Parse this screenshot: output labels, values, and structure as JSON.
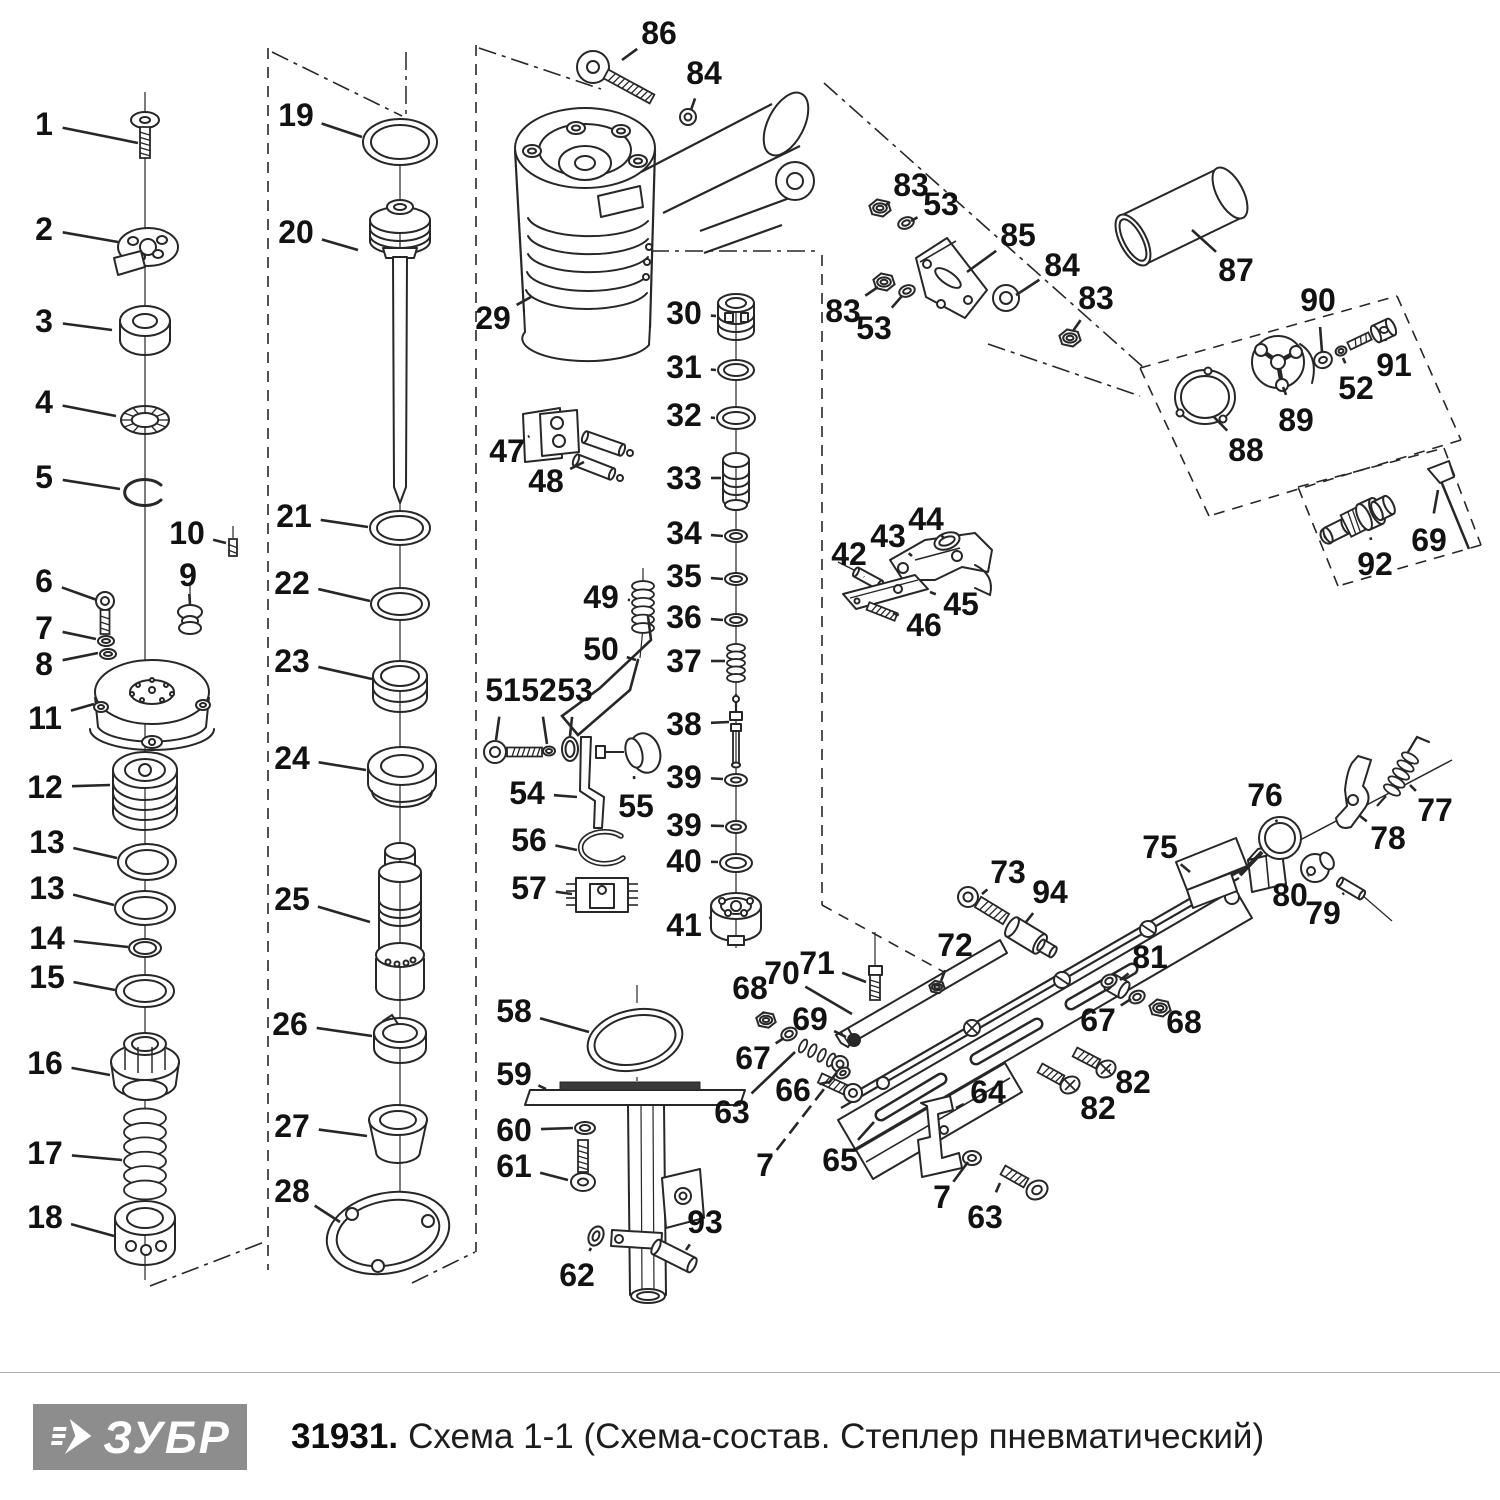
{
  "meta": {
    "brand": "ЗУБР",
    "product_code": "31931.",
    "title": "Схема 1-1 (Схема-состав. Степлер пневматический)"
  },
  "colors": {
    "ink": "#272727",
    "label": "#121212",
    "logo_bg": "#8d8d8d",
    "logo_fg": "#ffffff",
    "rule": "#ababab",
    "paper": "#ffffff"
  },
  "diagram": {
    "description": "exploded-parts-diagram-pneumatic-stapler",
    "labels": [
      {
        "n": "1",
        "x": 44,
        "y": 124,
        "ex": 138,
        "ey": 143
      },
      {
        "n": "2",
        "x": 44,
        "y": 229,
        "ex": 118,
        "ey": 242
      },
      {
        "n": "3",
        "x": 44,
        "y": 321,
        "ex": 112,
        "ey": 330
      },
      {
        "n": "4",
        "x": 44,
        "y": 402,
        "ex": 116,
        "ey": 416
      },
      {
        "n": "5",
        "x": 44,
        "y": 477,
        "ex": 120,
        "ey": 489
      },
      {
        "n": "6",
        "x": 44,
        "y": 581,
        "ex": 97,
        "ey": 600
      },
      {
        "n": "7",
        "x": 44,
        "y": 628,
        "ex": 96,
        "ey": 639
      },
      {
        "n": "8",
        "x": 44,
        "y": 664,
        "ex": 98,
        "ey": 653
      },
      {
        "n": "9",
        "x": 188,
        "y": 575,
        "ex": 190,
        "ey": 604
      },
      {
        "n": "10",
        "x": 187,
        "y": 533,
        "ex": 226,
        "ey": 543
      },
      {
        "n": "11",
        "x": 45,
        "y": 718,
        "ex": 94,
        "ey": 704
      },
      {
        "n": "12",
        "x": 45,
        "y": 787,
        "ex": 110,
        "ey": 785
      },
      {
        "n": "13",
        "x": 47,
        "y": 842,
        "ex": 117,
        "ey": 858
      },
      {
        "n": "13",
        "x": 47,
        "y": 888,
        "ex": 114,
        "ey": 905
      },
      {
        "n": "14",
        "x": 47,
        "y": 938,
        "ex": 128,
        "ey": 947
      },
      {
        "n": "15",
        "x": 47,
        "y": 977,
        "ex": 115,
        "ey": 990
      },
      {
        "n": "16",
        "x": 45,
        "y": 1063,
        "ex": 110,
        "ey": 1075
      },
      {
        "n": "17",
        "x": 45,
        "y": 1153,
        "ex": 122,
        "ey": 1160
      },
      {
        "n": "18",
        "x": 45,
        "y": 1217,
        "ex": 114,
        "ey": 1236
      },
      {
        "n": "19",
        "x": 296,
        "y": 115,
        "ex": 362,
        "ey": 137
      },
      {
        "n": "20",
        "x": 296,
        "y": 232,
        "ex": 358,
        "ey": 250
      },
      {
        "n": "21",
        "x": 294,
        "y": 516,
        "ex": 368,
        "ey": 527
      },
      {
        "n": "22",
        "x": 292,
        "y": 583,
        "ex": 370,
        "ey": 601
      },
      {
        "n": "23",
        "x": 292,
        "y": 661,
        "ex": 372,
        "ey": 679
      },
      {
        "n": "24",
        "x": 292,
        "y": 758,
        "ex": 366,
        "ey": 770
      },
      {
        "n": "25",
        "x": 292,
        "y": 899,
        "ex": 370,
        "ey": 922
      },
      {
        "n": "26",
        "x": 290,
        "y": 1024,
        "ex": 372,
        "ey": 1036
      },
      {
        "n": "27",
        "x": 292,
        "y": 1126,
        "ex": 367,
        "ey": 1136
      },
      {
        "n": "28",
        "x": 292,
        "y": 1191,
        "ex": 340,
        "ey": 1222
      },
      {
        "n": "29",
        "x": 493,
        "y": 318,
        "ex": 531,
        "ey": 297
      },
      {
        "n": "86",
        "x": 659,
        "y": 33,
        "ex": 622,
        "ey": 60
      },
      {
        "n": "84",
        "x": 704,
        "y": 73,
        "ex": 691,
        "ey": 110
      },
      {
        "n": "30",
        "x": 684,
        "y": 313,
        "ex": 716,
        "ey": 316
      },
      {
        "n": "31",
        "x": 684,
        "y": 367,
        "ex": 716,
        "ey": 370
      },
      {
        "n": "32",
        "x": 684,
        "y": 415,
        "ex": 715,
        "ey": 418
      },
      {
        "n": "33",
        "x": 684,
        "y": 478,
        "ex": 721,
        "ey": 478
      },
      {
        "n": "34",
        "x": 684,
        "y": 533,
        "ex": 723,
        "ey": 536
      },
      {
        "n": "35",
        "x": 684,
        "y": 576,
        "ex": 723,
        "ey": 579
      },
      {
        "n": "36",
        "x": 684,
        "y": 617,
        "ex": 723,
        "ey": 620
      },
      {
        "n": "37",
        "x": 684,
        "y": 661,
        "ex": 725,
        "ey": 661
      },
      {
        "n": "38",
        "x": 684,
        "y": 724,
        "ex": 729,
        "ey": 722
      },
      {
        "n": "39",
        "x": 684,
        "y": 777,
        "ex": 723,
        "ey": 779
      },
      {
        "n": "39",
        "x": 684,
        "y": 825,
        "ex": 724,
        "ey": 826
      },
      {
        "n": "40",
        "x": 684,
        "y": 861,
        "ex": 718,
        "ey": 862
      },
      {
        "n": "41",
        "x": 684,
        "y": 925,
        "ex": 709,
        "ey": 918
      },
      {
        "n": "47",
        "x": 507,
        "y": 451,
        "ex": 528,
        "ey": 437
      },
      {
        "n": "48",
        "x": 546,
        "y": 481,
        "ex": 584,
        "ey": 462
      },
      {
        "n": "49",
        "x": 601,
        "y": 597,
        "ex": 630,
        "ey": 600
      },
      {
        "n": "50",
        "x": 601,
        "y": 649,
        "ex": 636,
        "ey": 660
      },
      {
        "n": "51",
        "x": 503,
        "y": 690,
        "ex": 496,
        "ey": 740
      },
      {
        "n": "52",
        "x": 539,
        "y": 690,
        "ex": 547,
        "ey": 744
      },
      {
        "n": "53",
        "x": 575,
        "y": 690,
        "ex": 570,
        "ey": 736
      },
      {
        "n": "54",
        "x": 527,
        "y": 793,
        "ex": 577,
        "ey": 797
      },
      {
        "n": "55",
        "x": 636,
        "y": 806,
        "ex": 634,
        "ey": 776
      },
      {
        "n": "56",
        "x": 529,
        "y": 840,
        "ex": 577,
        "ey": 850
      },
      {
        "n": "57",
        "x": 529,
        "y": 888,
        "ex": 572,
        "ey": 894
      },
      {
        "n": "58",
        "x": 514,
        "y": 1011,
        "ex": 589,
        "ey": 1032
      },
      {
        "n": "59",
        "x": 514,
        "y": 1074,
        "ex": 546,
        "ey": 1089
      },
      {
        "n": "60",
        "x": 514,
        "y": 1130,
        "ex": 573,
        "ey": 1128
      },
      {
        "n": "61",
        "x": 514,
        "y": 1166,
        "ex": 568,
        "ey": 1180
      },
      {
        "n": "62",
        "x": 577,
        "y": 1275,
        "ex": 591,
        "ey": 1248
      },
      {
        "n": "93",
        "x": 705,
        "y": 1222,
        "ex": 686,
        "ey": 1250
      },
      {
        "n": "42",
        "x": 849,
        "y": 554,
        "ex": 864,
        "ey": 577
      },
      {
        "n": "43",
        "x": 888,
        "y": 536,
        "ex": 912,
        "ey": 556
      },
      {
        "n": "44",
        "x": 926,
        "y": 519,
        "ex": 941,
        "ey": 535
      },
      {
        "n": "45",
        "x": 961,
        "y": 604,
        "ex": 930,
        "ey": 592
      },
      {
        "n": "46",
        "x": 924,
        "y": 625,
        "ex": 893,
        "ey": 613
      },
      {
        "n": "83",
        "x": 911,
        "y": 185,
        "ex": 886,
        "ey": 205
      },
      {
        "n": "53",
        "x": 941,
        "y": 204,
        "ex": 911,
        "ey": 221
      },
      {
        "n": "85",
        "x": 1018,
        "y": 235,
        "ex": 967,
        "ey": 272
      },
      {
        "n": "84",
        "x": 1062,
        "y": 265,
        "ex": 1016,
        "ey": 295
      },
      {
        "n": "83",
        "x": 843,
        "y": 311,
        "ex": 878,
        "ey": 287
      },
      {
        "n": "53",
        "x": 874,
        "y": 328,
        "ex": 902,
        "ey": 296
      },
      {
        "n": "83",
        "x": 1096,
        "y": 298,
        "ex": 1073,
        "ey": 331
      },
      {
        "n": "87",
        "x": 1236,
        "y": 270,
        "ex": 1192,
        "ey": 230
      },
      {
        "n": "90",
        "x": 1318,
        "y": 300,
        "ex": 1322,
        "ey": 352
      },
      {
        "n": "91",
        "x": 1394,
        "y": 365,
        "ex": 1386,
        "ey": 341
      },
      {
        "n": "52",
        "x": 1356,
        "y": 388,
        "ex": 1343,
        "ey": 358
      },
      {
        "n": "89",
        "x": 1296,
        "y": 420,
        "ex": 1283,
        "ey": 387
      },
      {
        "n": "88",
        "x": 1246,
        "y": 450,
        "ex": 1214,
        "ey": 417
      },
      {
        "n": "92",
        "x": 1375,
        "y": 564,
        "ex": 1371,
        "ey": 540
      },
      {
        "n": "69",
        "x": 1429,
        "y": 540,
        "ex": 1438,
        "ey": 490
      },
      {
        "n": "73",
        "x": 1008,
        "y": 872,
        "ex": 982,
        "ey": 894
      },
      {
        "n": "94",
        "x": 1050,
        "y": 892,
        "ex": 1026,
        "ey": 922
      },
      {
        "n": "75",
        "x": 1160,
        "y": 847,
        "ex": 1190,
        "ey": 872
      },
      {
        "n": "76",
        "x": 1265,
        "y": 795,
        "ex": 1277,
        "ey": 822
      },
      {
        "n": "77",
        "x": 1435,
        "y": 810,
        "ex": 1410,
        "ey": 785
      },
      {
        "n": "78",
        "x": 1388,
        "y": 838,
        "ex": 1360,
        "ey": 816
      },
      {
        "n": "80",
        "x": 1290,
        "y": 895,
        "ex": 1308,
        "ey": 876
      },
      {
        "n": "79",
        "x": 1323,
        "y": 913,
        "ex": 1344,
        "ey": 893
      },
      {
        "n": "72",
        "x": 955,
        "y": 945,
        "ex": 941,
        "ey": 981
      },
      {
        "n": "71",
        "x": 817,
        "y": 963,
        "ex": 866,
        "ey": 982
      },
      {
        "n": "70",
        "x": 782,
        "y": 973,
        "ex": 852,
        "ey": 1014
      },
      {
        "n": "68",
        "x": 750,
        "y": 988,
        "ex": 764,
        "ey": 1014
      },
      {
        "n": "69",
        "x": 810,
        "y": 1019,
        "ex": 846,
        "ey": 1037
      },
      {
        "n": "67",
        "x": 753,
        "y": 1058,
        "ex": 784,
        "ey": 1038
      },
      {
        "n": "66",
        "x": 793,
        "y": 1090,
        "ex": 829,
        "ey": 1082
      },
      {
        "n": "63",
        "x": 732,
        "y": 1112,
        "ex": 795,
        "ey": 1052
      },
      {
        "n": "81",
        "x": 1150,
        "y": 957,
        "ex": 1120,
        "ey": 980
      },
      {
        "n": "67",
        "x": 1098,
        "y": 1020,
        "ex": 1131,
        "ey": 999
      },
      {
        "n": "68",
        "x": 1184,
        "y": 1022,
        "ex": 1162,
        "ey": 1011
      },
      {
        "n": "82",
        "x": 1133,
        "y": 1082,
        "ex": 1110,
        "ey": 1071
      },
      {
        "n": "82",
        "x": 1098,
        "y": 1108,
        "ex": 1076,
        "ey": 1089
      },
      {
        "n": "64",
        "x": 988,
        "y": 1092,
        "ex": 956,
        "ey": 1108
      },
      {
        "n": "65",
        "x": 840,
        "y": 1160,
        "ex": 874,
        "ey": 1122
      },
      {
        "n": "7",
        "x": 765,
        "y": 1165,
        "ex": 838,
        "ey": 1071,
        "dash": 1
      },
      {
        "n": "7",
        "x": 942,
        "y": 1197,
        "ex": 968,
        "ey": 1162
      },
      {
        "n": "63",
        "x": 985,
        "y": 1217,
        "ex": 1000,
        "ey": 1183
      }
    ]
  }
}
